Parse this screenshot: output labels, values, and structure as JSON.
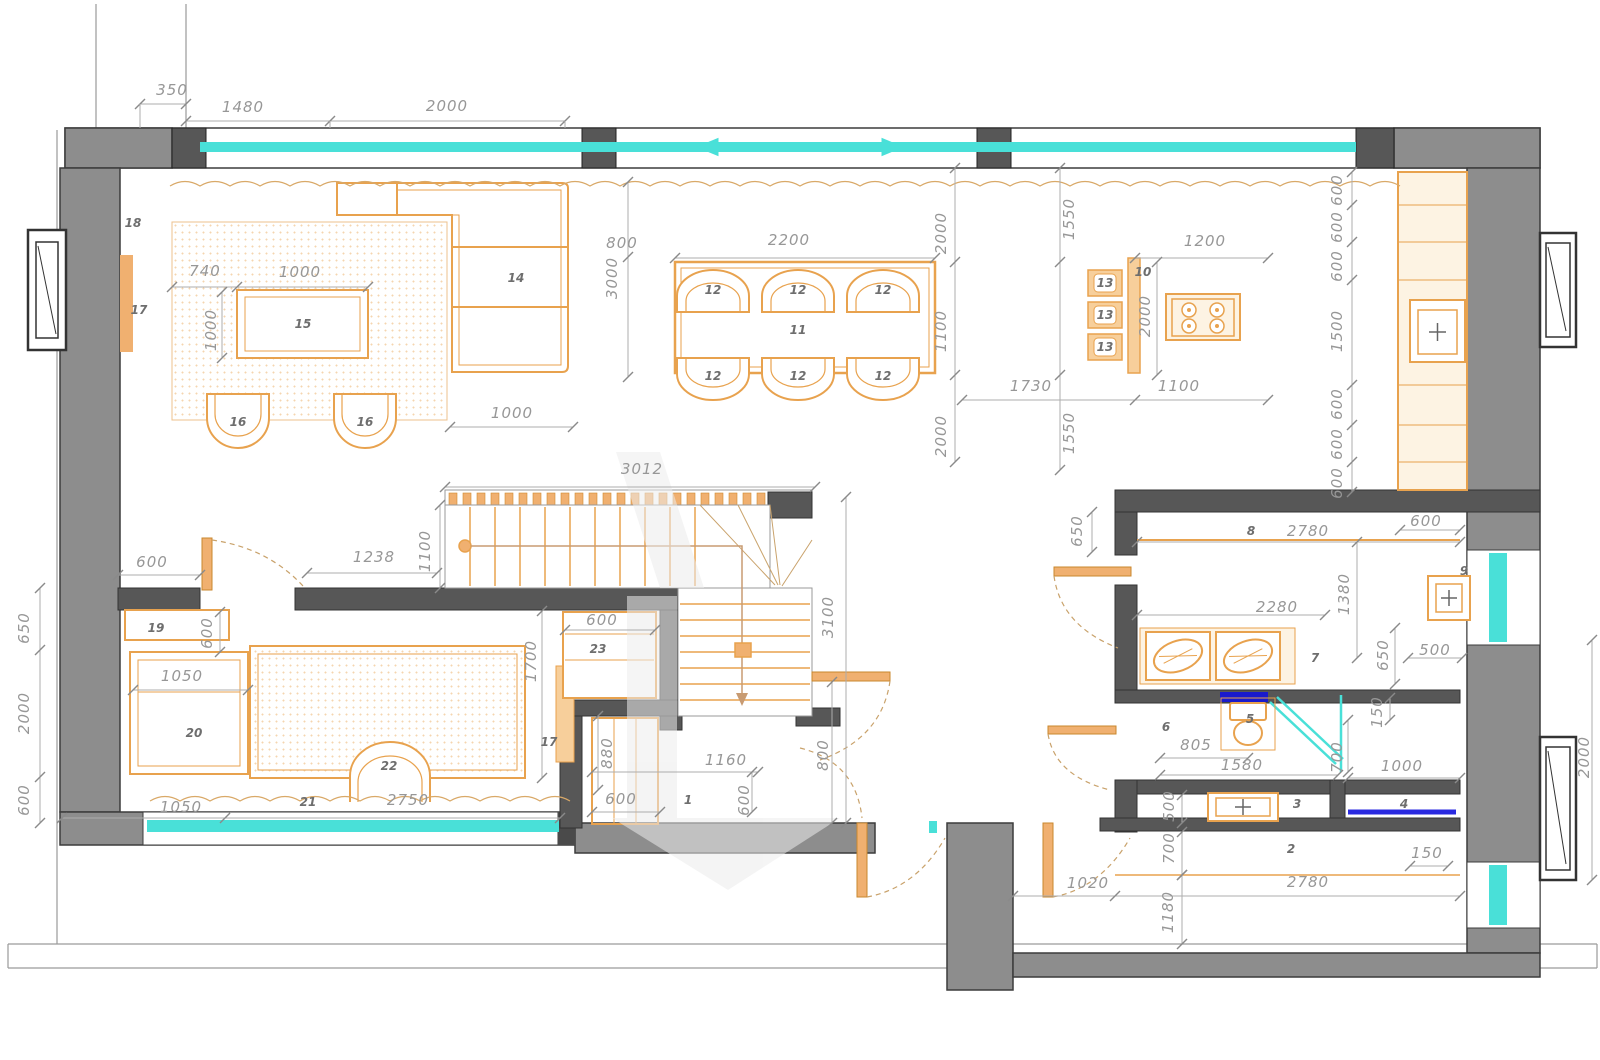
{
  "drawing": {
    "kind": "architectural-floor-plan",
    "level": "apartment-plan-with-dimensions"
  },
  "colors": {
    "wall": "#8d8d8d",
    "wall_dark": "#575757",
    "wall_edge": "#3c3c3c",
    "furniture": "#e8a24e",
    "furniture_light": "#fdf3e3",
    "glass_cyan": "#49e0d8",
    "tub_blue": "#2a2ae0",
    "navy": "#1a1acc",
    "dim_text": "#979797",
    "dim_line": "#adadad",
    "watermark": "#ececec"
  },
  "dim_labels": [
    {
      "text": "350",
      "x": 172,
      "y": 90,
      "rot": 0
    },
    {
      "text": "1480",
      "x": 243,
      "y": 107,
      "rot": 0
    },
    {
      "text": "2000",
      "x": 447,
      "y": 106,
      "rot": 0
    },
    {
      "text": "740",
      "x": 205,
      "y": 271,
      "rot": 0
    },
    {
      "text": "1000",
      "x": 300,
      "y": 272,
      "rot": 0
    },
    {
      "text": "1000",
      "x": 211,
      "y": 330,
      "rot": -90
    },
    {
      "text": "800",
      "x": 622,
      "y": 243,
      "rot": 0
    },
    {
      "text": "3000",
      "x": 612,
      "y": 278,
      "rot": -90
    },
    {
      "text": "1000",
      "x": 512,
      "y": 413,
      "rot": 0
    },
    {
      "text": "2200",
      "x": 789,
      "y": 240,
      "rot": 0
    },
    {
      "text": "2000",
      "x": 941,
      "y": 233,
      "rot": -90
    },
    {
      "text": "1100",
      "x": 941,
      "y": 331,
      "rot": -90
    },
    {
      "text": "2000",
      "x": 941,
      "y": 436,
      "rot": -90
    },
    {
      "text": "1550",
      "x": 1069,
      "y": 219,
      "rot": -90
    },
    {
      "text": "1200",
      "x": 1205,
      "y": 241,
      "rot": 0
    },
    {
      "text": "2000",
      "x": 1145,
      "y": 316,
      "rot": -90
    },
    {
      "text": "1730",
      "x": 1031,
      "y": 386,
      "rot": 0
    },
    {
      "text": "1100",
      "x": 1179,
      "y": 386,
      "rot": 0
    },
    {
      "text": "1550",
      "x": 1069,
      "y": 433,
      "rot": -90
    },
    {
      "text": "600",
      "x": 1337,
      "y": 190,
      "rot": -90
    },
    {
      "text": "600",
      "x": 1337,
      "y": 227,
      "rot": -90
    },
    {
      "text": "600",
      "x": 1337,
      "y": 266,
      "rot": -90
    },
    {
      "text": "1500",
      "x": 1337,
      "y": 331,
      "rot": -90
    },
    {
      "text": "600",
      "x": 1337,
      "y": 404,
      "rot": -90
    },
    {
      "text": "600",
      "x": 1337,
      "y": 444,
      "rot": -90
    },
    {
      "text": "600",
      "x": 1337,
      "y": 483,
      "rot": -90
    },
    {
      "text": "3012",
      "x": 642,
      "y": 469,
      "rot": 0
    },
    {
      "text": "1100",
      "x": 425,
      "y": 551,
      "rot": -90
    },
    {
      "text": "3100",
      "x": 828,
      "y": 617,
      "rot": -90
    },
    {
      "text": "1238",
      "x": 374,
      "y": 557,
      "rot": 0
    },
    {
      "text": "600",
      "x": 152,
      "y": 562,
      "rot": 0
    },
    {
      "text": "650",
      "x": 24,
      "y": 628,
      "rot": -90
    },
    {
      "text": "2000",
      "x": 24,
      "y": 713,
      "rot": -90
    },
    {
      "text": "600",
      "x": 24,
      "y": 800,
      "rot": -90
    },
    {
      "text": "600",
      "x": 207,
      "y": 633,
      "rot": -90
    },
    {
      "text": "1050",
      "x": 182,
      "y": 676,
      "rot": 0
    },
    {
      "text": "1050",
      "x": 181,
      "y": 807,
      "rot": 0
    },
    {
      "text": "2750",
      "x": 408,
      "y": 800,
      "rot": 0
    },
    {
      "text": "1700",
      "x": 531,
      "y": 661,
      "rot": -90
    },
    {
      "text": "600",
      "x": 602,
      "y": 620,
      "rot": 0
    },
    {
      "text": "880",
      "x": 607,
      "y": 753,
      "rot": -90
    },
    {
      "text": "1160",
      "x": 726,
      "y": 760,
      "rot": 0
    },
    {
      "text": "600",
      "x": 621,
      "y": 799,
      "rot": 0
    },
    {
      "text": "600",
      "x": 744,
      "y": 800,
      "rot": -90
    },
    {
      "text": "800",
      "x": 823,
      "y": 755,
      "rot": -90
    },
    {
      "text": "650",
      "x": 1077,
      "y": 531,
      "rot": -90
    },
    {
      "text": "2780",
      "x": 1308,
      "y": 531,
      "rot": 0
    },
    {
      "text": "600",
      "x": 1426,
      "y": 521,
      "rot": 0
    },
    {
      "text": "2280",
      "x": 1277,
      "y": 607,
      "rot": 0
    },
    {
      "text": "1380",
      "x": 1344,
      "y": 594,
      "rot": -90
    },
    {
      "text": "650",
      "x": 1383,
      "y": 655,
      "rot": -90
    },
    {
      "text": "500",
      "x": 1435,
      "y": 650,
      "rot": 0
    },
    {
      "text": "805",
      "x": 1196,
      "y": 745,
      "rot": 0
    },
    {
      "text": "1580",
      "x": 1242,
      "y": 765,
      "rot": 0
    },
    {
      "text": "150",
      "x": 1377,
      "y": 712,
      "rot": -90
    },
    {
      "text": "700",
      "x": 1337,
      "y": 757,
      "rot": -90
    },
    {
      "text": "1000",
      "x": 1402,
      "y": 766,
      "rot": 0
    },
    {
      "text": "500",
      "x": 1169,
      "y": 806,
      "rot": -90
    },
    {
      "text": "700",
      "x": 1169,
      "y": 848,
      "rot": -90
    },
    {
      "text": "1020",
      "x": 1088,
      "y": 883,
      "rot": 0
    },
    {
      "text": "2780",
      "x": 1308,
      "y": 882,
      "rot": 0
    },
    {
      "text": "150",
      "x": 1427,
      "y": 853,
      "rot": 0
    },
    {
      "text": "1180",
      "x": 1168,
      "y": 912,
      "rot": -90
    },
    {
      "text": "2000",
      "x": 1584,
      "y": 757,
      "rot": -90
    }
  ],
  "room_labels": [
    {
      "text": "18",
      "x": 133,
      "y": 223
    },
    {
      "text": "17",
      "x": 139,
      "y": 310
    },
    {
      "text": "15",
      "x": 303,
      "y": 324
    },
    {
      "text": "14",
      "x": 516,
      "y": 278
    },
    {
      "text": "16",
      "x": 238,
      "y": 422
    },
    {
      "text": "16",
      "x": 365,
      "y": 422
    },
    {
      "text": "11",
      "x": 798,
      "y": 330
    },
    {
      "text": "12",
      "x": 713,
      "y": 290
    },
    {
      "text": "12",
      "x": 798,
      "y": 290
    },
    {
      "text": "12",
      "x": 883,
      "y": 290
    },
    {
      "text": "12",
      "x": 713,
      "y": 376
    },
    {
      "text": "12",
      "x": 798,
      "y": 376
    },
    {
      "text": "12",
      "x": 883,
      "y": 376
    },
    {
      "text": "13",
      "x": 1105,
      "y": 283
    },
    {
      "text": "13",
      "x": 1105,
      "y": 315
    },
    {
      "text": "13",
      "x": 1105,
      "y": 347
    },
    {
      "text": "10",
      "x": 1143,
      "y": 272
    },
    {
      "text": "19",
      "x": 156,
      "y": 628
    },
    {
      "text": "20",
      "x": 194,
      "y": 733
    },
    {
      "text": "21",
      "x": 308,
      "y": 802
    },
    {
      "text": "22",
      "x": 389,
      "y": 766
    },
    {
      "text": "23",
      "x": 598,
      "y": 649
    },
    {
      "text": "17",
      "x": 549,
      "y": 742
    },
    {
      "text": "1",
      "x": 688,
      "y": 800
    },
    {
      "text": "8",
      "x": 1251,
      "y": 531
    },
    {
      "text": "9",
      "x": 1464,
      "y": 571
    },
    {
      "text": "7",
      "x": 1315,
      "y": 658
    },
    {
      "text": "6",
      "x": 1166,
      "y": 727
    },
    {
      "text": "5",
      "x": 1250,
      "y": 719
    },
    {
      "text": "3",
      "x": 1297,
      "y": 804
    },
    {
      "text": "4",
      "x": 1404,
      "y": 804
    },
    {
      "text": "2",
      "x": 1291,
      "y": 849
    }
  ]
}
